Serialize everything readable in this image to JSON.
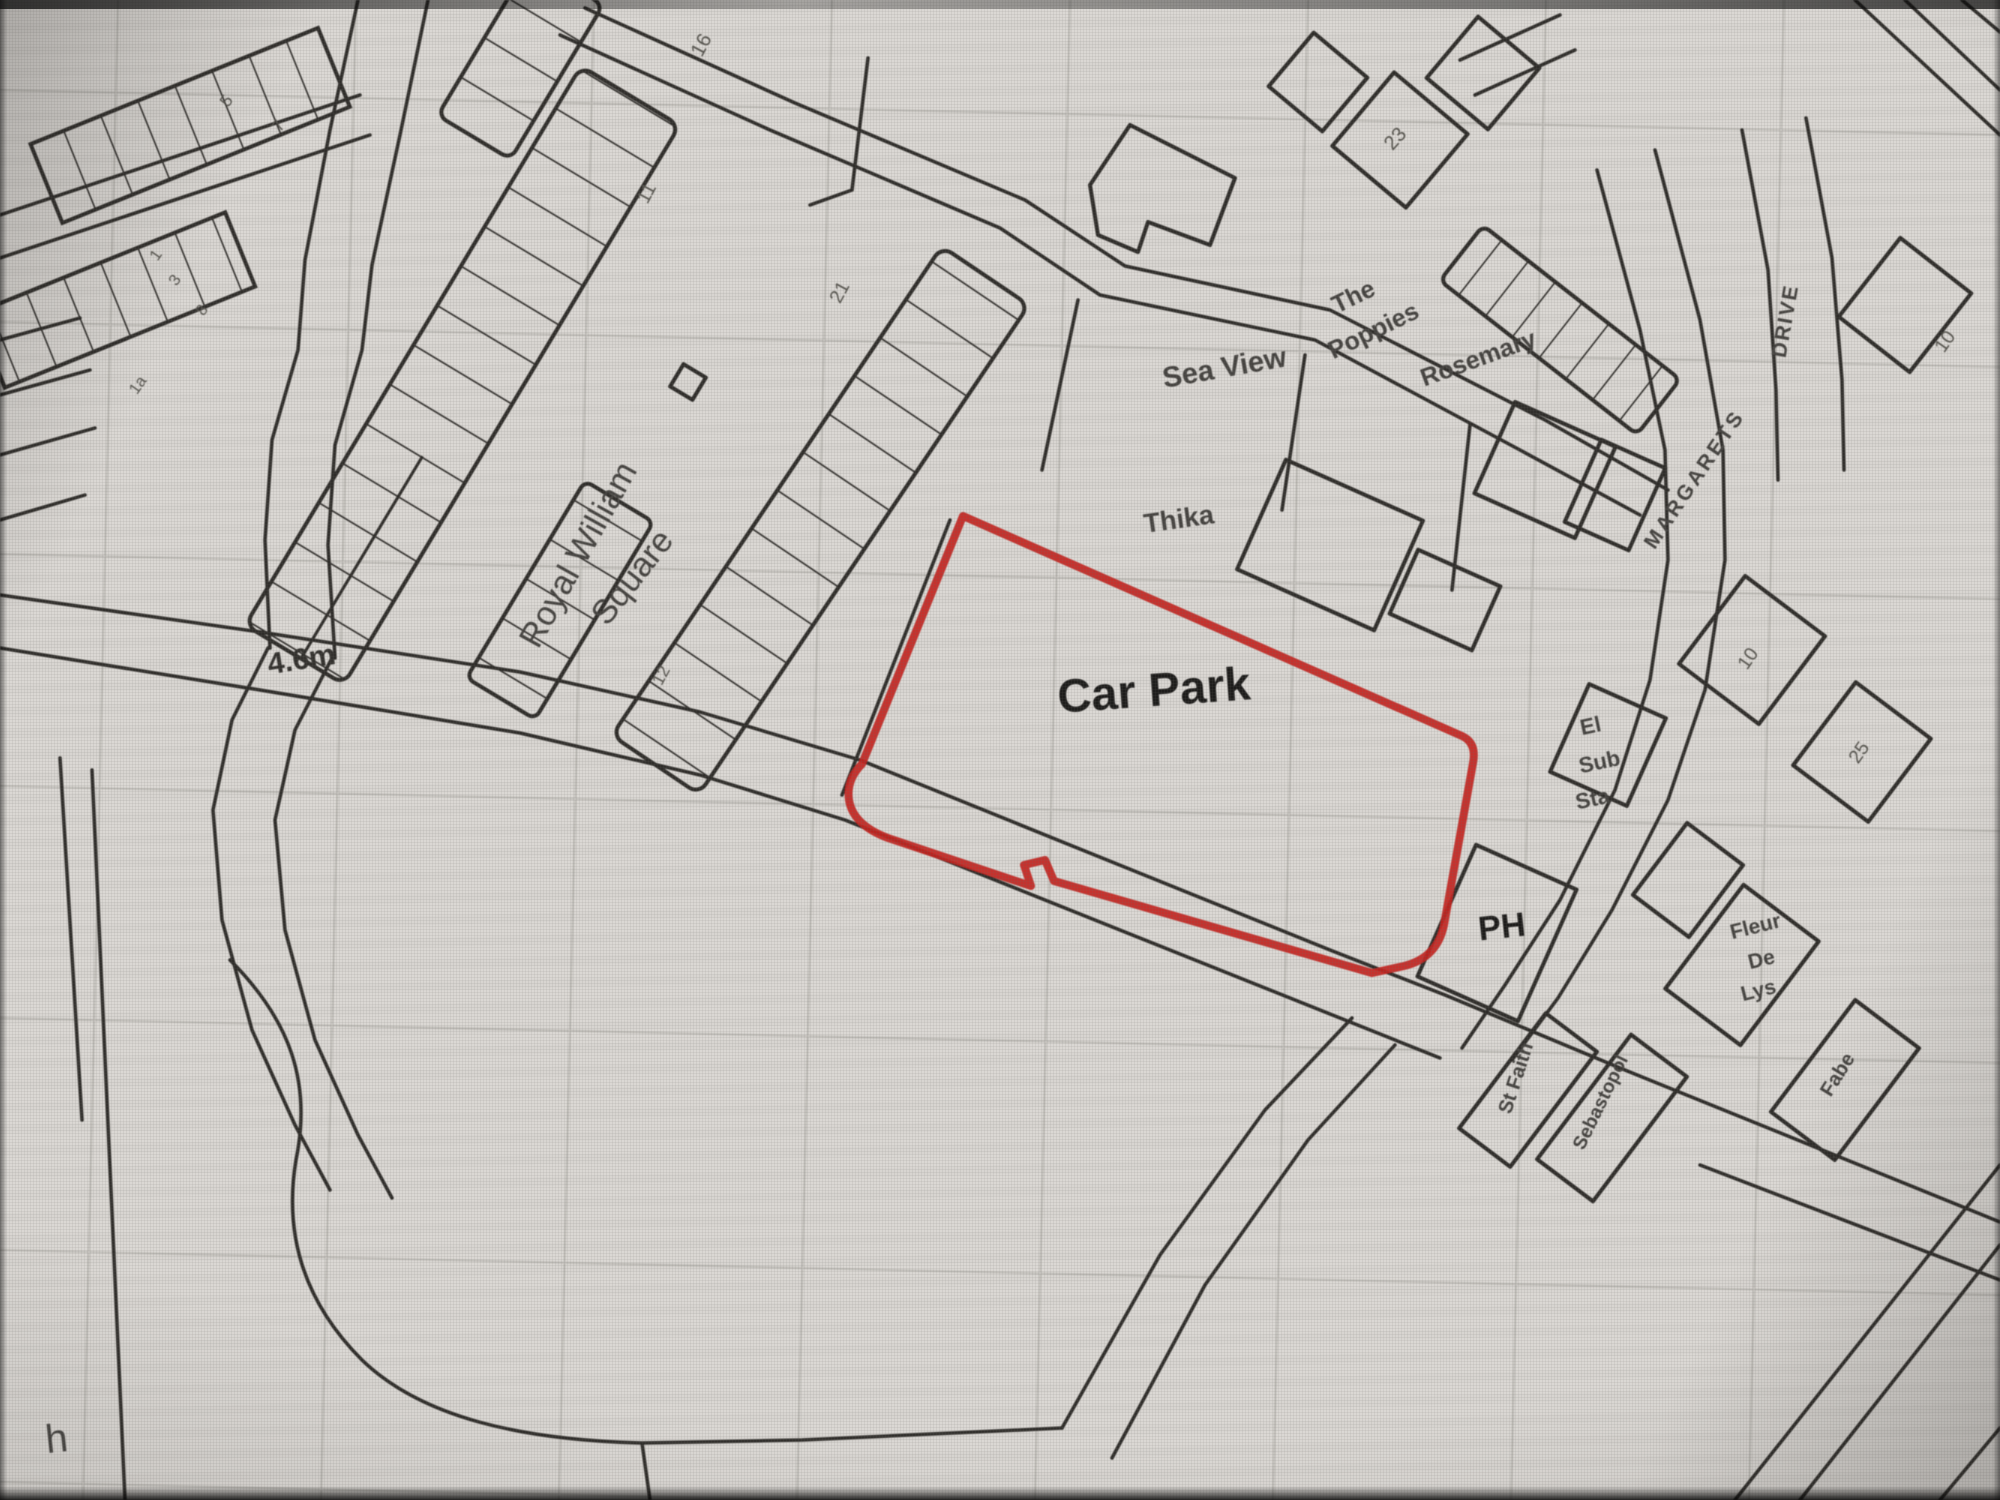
{
  "map": {
    "colors": {
      "paper": "#dbd8d4",
      "ink": "#2f2d2a",
      "grid": "#bcb9b4",
      "label": "#454340",
      "number": "#57554f"
    },
    "site_boundary": {
      "label": "Car Park",
      "color": "#c32420"
    },
    "labels": [
      {
        "id": "royal-william",
        "text": "Royal William",
        "x": 588,
        "y": 560,
        "rot": -61,
        "size": 34,
        "weight": 500
      },
      {
        "id": "square",
        "text": "Square",
        "x": 641,
        "y": 584,
        "rot": -52,
        "size": 34,
        "weight": 500
      },
      {
        "id": "sea-view",
        "text": "Sea View",
        "x": 1226,
        "y": 377,
        "rot": -10,
        "size": 29,
        "weight": 600
      },
      {
        "id": "the",
        "text": "The",
        "x": 1357,
        "y": 304,
        "rot": -26,
        "size": 25,
        "weight": 600
      },
      {
        "id": "poppies",
        "text": "Poppies",
        "x": 1377,
        "y": 338,
        "rot": -26,
        "size": 25,
        "weight": 600
      },
      {
        "id": "rosemary",
        "text": "Rosemary",
        "x": 1481,
        "y": 366,
        "rot": -20,
        "size": 25,
        "weight": 600
      },
      {
        "id": "thika",
        "text": "Thika",
        "x": 1180,
        "y": 528,
        "rot": -8,
        "size": 27,
        "weight": 700
      },
      {
        "id": "car-park",
        "text": "Car Park",
        "x": 1155,
        "y": 706,
        "rot": -4,
        "size": 47,
        "weight": 700,
        "color": "#1d1c1b"
      },
      {
        "id": "height-4-6m",
        "text": "4.6m",
        "x": 303,
        "y": 669,
        "rot": -9,
        "size": 30,
        "weight": 600,
        "color": "#33312e"
      },
      {
        "id": "el",
        "text": "El",
        "x": 1592,
        "y": 733,
        "rot": -12,
        "size": 22,
        "weight": 600
      },
      {
        "id": "sub",
        "text": "Sub",
        "x": 1601,
        "y": 769,
        "rot": -12,
        "size": 22,
        "weight": 600
      },
      {
        "id": "sta",
        "text": "Sta",
        "x": 1594,
        "y": 806,
        "rot": -12,
        "size": 22,
        "weight": 600
      },
      {
        "id": "ph",
        "text": "PH",
        "x": 1503,
        "y": 938,
        "rot": -6,
        "size": 34,
        "weight": 700,
        "color": "#1d1c1b"
      },
      {
        "id": "fleur",
        "text": "Fleur",
        "x": 1757,
        "y": 933,
        "rot": -14,
        "size": 21,
        "weight": 600
      },
      {
        "id": "de",
        "text": "De",
        "x": 1763,
        "y": 966,
        "rot": -14,
        "size": 21,
        "weight": 600
      },
      {
        "id": "lys",
        "text": "Lys",
        "x": 1760,
        "y": 997,
        "rot": -14,
        "size": 21,
        "weight": 600
      },
      {
        "id": "st-faith",
        "text": "St Faith",
        "x": 1522,
        "y": 1080,
        "rot": -72,
        "size": 20,
        "weight": 600
      },
      {
        "id": "sebastopol",
        "text": "Sebastopol",
        "x": 1606,
        "y": 1105,
        "rot": -64,
        "size": 19,
        "weight": 600
      },
      {
        "id": "margarets",
        "text": "MARGARETS",
        "x": 1700,
        "y": 483,
        "rot": -56,
        "size": 21,
        "weight": 600,
        "ls": 3
      },
      {
        "id": "drive",
        "text": "DRIVE",
        "x": 1792,
        "y": 322,
        "rot": -80,
        "size": 21,
        "weight": 600,
        "ls": 2
      },
      {
        "id": "fabe",
        "text": "Fabe",
        "x": 1843,
        "y": 1078,
        "rot": -58,
        "size": 20,
        "weight": 600
      },
      {
        "id": "h-partial",
        "text": "h",
        "x": 58,
        "y": 1452,
        "rot": -6,
        "size": 40,
        "weight": 500
      },
      {
        "id": "no-16",
        "text": "16",
        "x": 707,
        "y": 48,
        "rot": -62,
        "size": 20,
        "color": "#57554f"
      },
      {
        "id": "no-11",
        "text": "11",
        "x": 652,
        "y": 196,
        "rot": -62,
        "size": 19,
        "color": "#57554f"
      },
      {
        "id": "no-21",
        "text": "21",
        "x": 845,
        "y": 295,
        "rot": -62,
        "size": 19,
        "color": "#57554f"
      },
      {
        "id": "no-12",
        "text": "12",
        "x": 666,
        "y": 678,
        "rot": -62,
        "size": 17,
        "color": "#57554f"
      },
      {
        "id": "no-23",
        "text": "23",
        "x": 1400,
        "y": 143,
        "rot": -48,
        "size": 20,
        "color": "#57554f"
      },
      {
        "id": "no-10",
        "text": "10",
        "x": 1753,
        "y": 662,
        "rot": -55,
        "size": 19,
        "color": "#57554f"
      },
      {
        "id": "no-25",
        "text": "25",
        "x": 1864,
        "y": 756,
        "rot": -55,
        "size": 19,
        "color": "#57554f"
      },
      {
        "id": "no-10b",
        "text": "10",
        "x": 1950,
        "y": 345,
        "rot": -55,
        "size": 19,
        "color": "#57554f"
      },
      {
        "id": "no-5",
        "text": "5",
        "x": 231,
        "y": 104,
        "rot": -55,
        "size": 17,
        "color": "#57554f"
      },
      {
        "id": "no-7",
        "text": "7",
        "x": 283,
        "y": 129,
        "rot": -55,
        "size": 17,
        "color": "#57554f"
      },
      {
        "id": "no-1",
        "text": "1",
        "x": 160,
        "y": 258,
        "rot": -55,
        "size": 16,
        "color": "#57554f"
      },
      {
        "id": "no-3",
        "text": "3",
        "x": 179,
        "y": 283,
        "rot": -55,
        "size": 16,
        "color": "#57554f"
      },
      {
        "id": "no-8",
        "text": "8",
        "x": 206,
        "y": 313,
        "rot": -55,
        "size": 16,
        "color": "#57554f"
      },
      {
        "id": "no-1a",
        "text": "1a",
        "x": 142,
        "y": 388,
        "rot": -55,
        "size": 16,
        "color": "#57554f"
      }
    ]
  }
}
